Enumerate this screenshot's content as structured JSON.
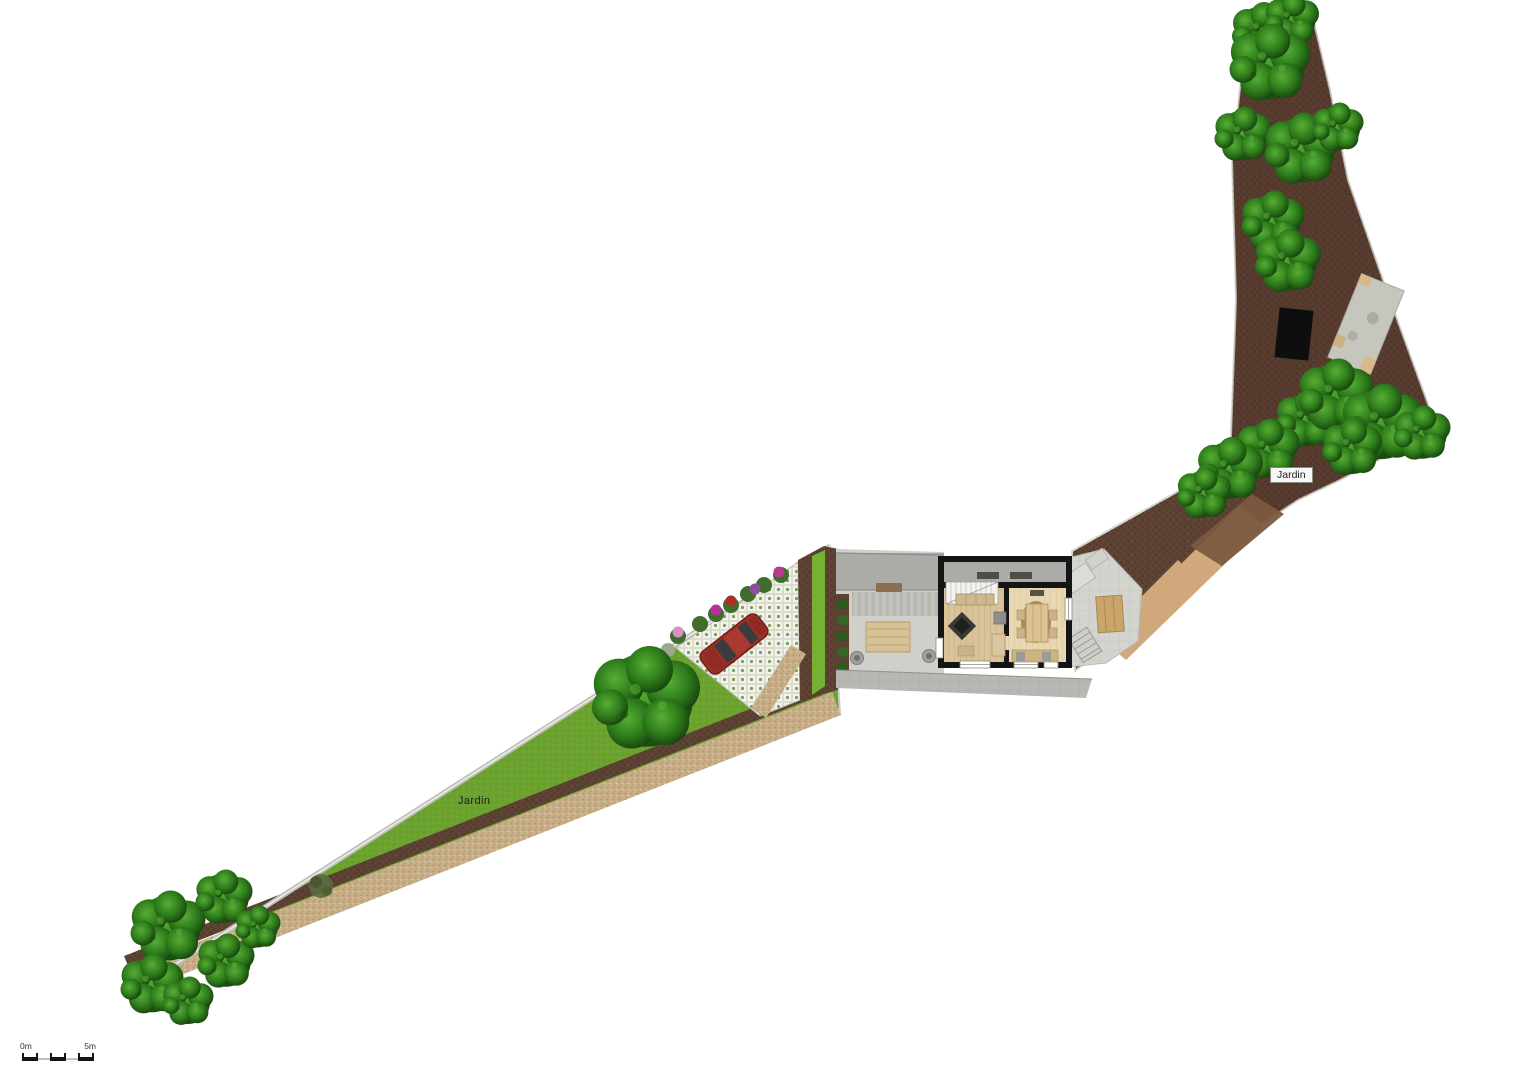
{
  "plan": {
    "labels": {
      "garden_left": "Jardin",
      "garden_right": "Jardin"
    },
    "scale_bar": {
      "start_label": "0m",
      "end_label": "5m"
    }
  },
  "colors": {
    "background": "#ffffff",
    "lawn": "#6CA32F",
    "lawn_strip": "#76B135",
    "tree_light": "#57AE35",
    "tree_mid": "#2F7D1C",
    "tree_dark": "#15400C",
    "soil": "#5D4132",
    "soil_upper": "#523828",
    "gravel": "#C7AE86",
    "paver_base": "#EDEDE3",
    "paver_dot": "#7AA157",
    "courtyard": "#D0D0CA",
    "walk_band": "#ABABA7",
    "stone_path": "#B7B7B3",
    "patio": "#D4D4CE",
    "house_wall": "#141414",
    "floor_living": "#DAC39B",
    "floor_dining": "#E9D7B2",
    "deck_wood": "#D5C193",
    "table_wood": "#C9A56C",
    "car": "#9E2F28",
    "sand_path": "#D0A87B",
    "sand_patch": "#7B5A40",
    "label_text": "#222222"
  }
}
